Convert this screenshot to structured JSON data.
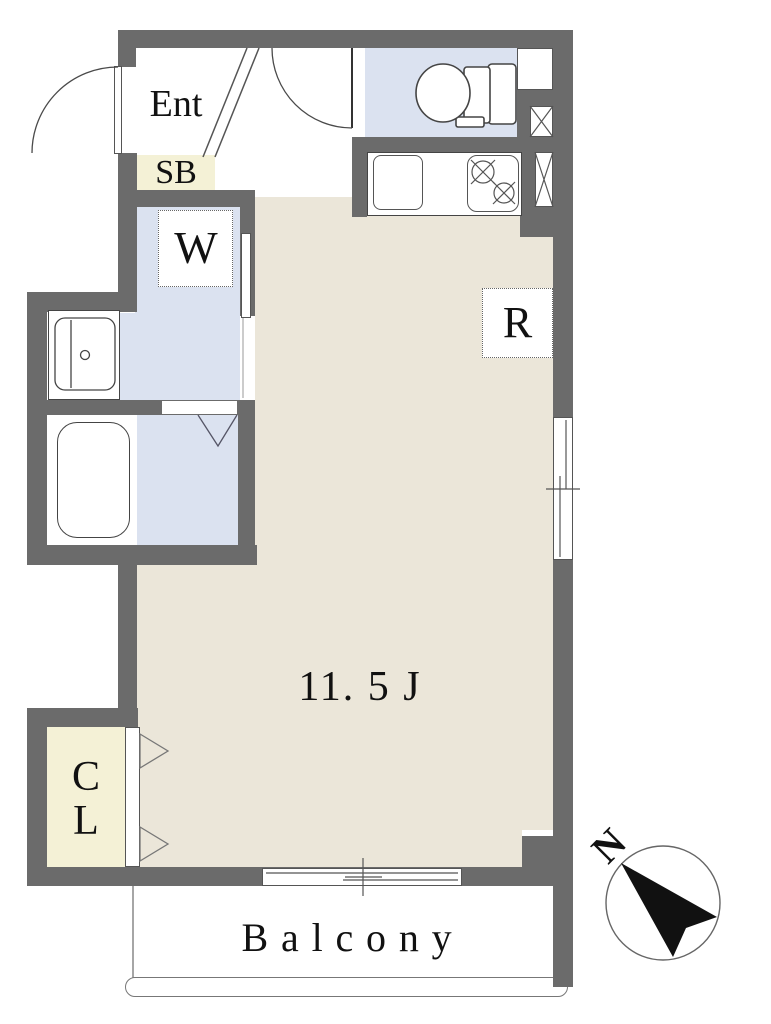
{
  "floorplan": {
    "labels": {
      "entrance": "Ent",
      "shoe_box": "SB",
      "washing_machine": "W",
      "refrigerator": "R",
      "main_room_size": "11. 5 J",
      "closet_line1": "C",
      "closet_line2": "L",
      "balcony": "Balcony",
      "compass_north": "N"
    },
    "colors": {
      "wall": "#6b6b6b",
      "main_room_floor": "#ebe6d9",
      "wet_area_floor": "#dbe2f0",
      "storage_fill": "#f4f1d6",
      "outline": "#4a4a4a",
      "compass_arrow": "#111111"
    }
  }
}
